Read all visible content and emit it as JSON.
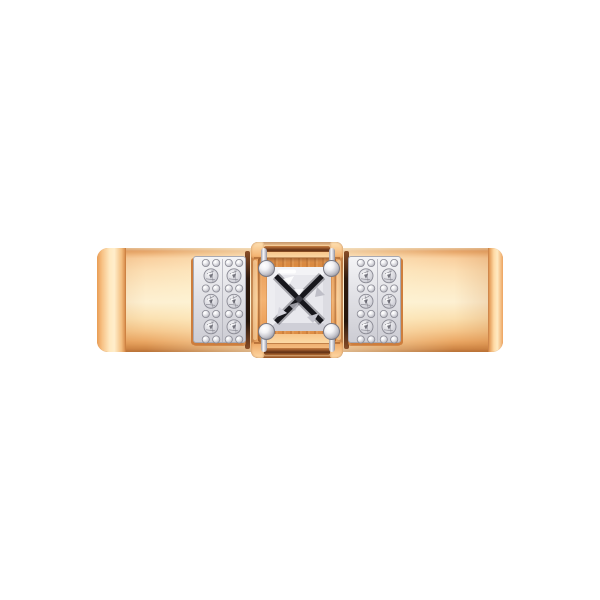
{
  "image": {
    "background": "#ffffff",
    "subject": "rose gold band ring, front view, princess-cut center diamond with four prong balls, two pave diamond plates"
  },
  "palette": {
    "bg": "#ffffff",
    "gold-highlight": "#ffeecb",
    "gold-light": "#fde9c4",
    "gold-mid": "#f7c68c",
    "gold-deep": "#e89e58",
    "gold-shadow": "#c97e3f",
    "gold-edge": "#a85f2a",
    "metal-white": "#f8f8fa",
    "metal-light": "#e8e8ec",
    "metal-mid": "#c6c6cd",
    "metal-dark": "#8a8a94",
    "stone-dark": "#17171c",
    "slit-dark": "#2e1a0e"
  },
  "jewelry": {
    "center_stone": {
      "cut": "princess",
      "prong_count": 4
    },
    "side_plates": {
      "count": 2,
      "columns_per_plate": 2,
      "stones_per_column": 3,
      "bead_rows_per_column": 4,
      "total_side_stones": 12
    }
  },
  "pave_layout": {
    "plate_w": 53,
    "plate_h": 87,
    "col_x": [
      17,
      40
    ],
    "stone_y": [
      18.8,
      44.3,
      69.8
    ],
    "bead_y": [
      6,
      31.5,
      57,
      82.5
    ],
    "bead_dx": 5.2,
    "stone_r": 7,
    "bead_r": 3.6
  }
}
